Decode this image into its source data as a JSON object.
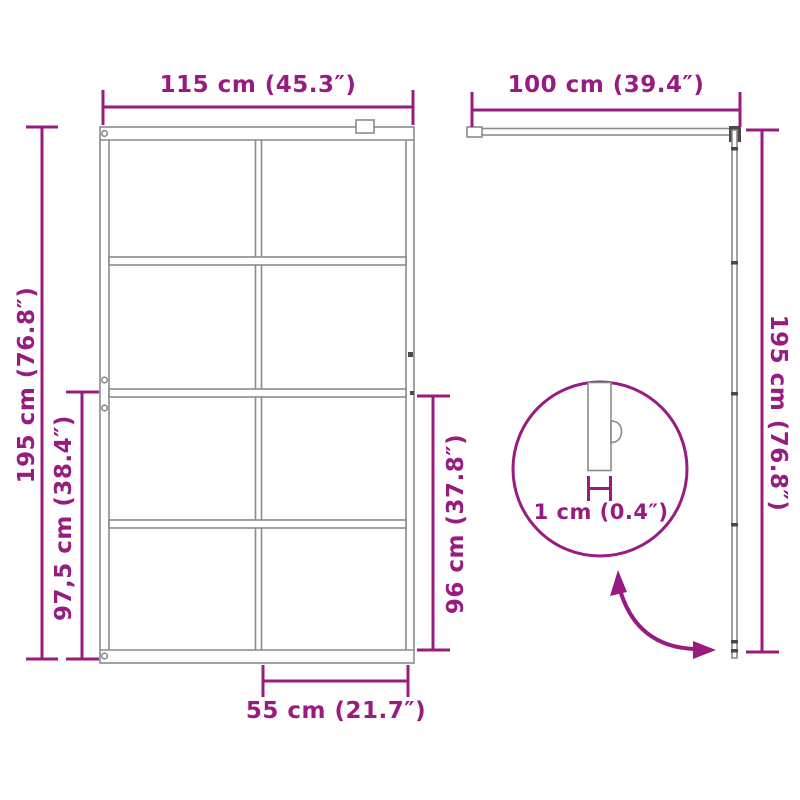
{
  "page": {
    "background": "#ffffff",
    "type": "product-dimension-diagram"
  },
  "colors": {
    "accent": "#981b80",
    "drawing_line": "#8a8a8a",
    "dark_fitting": "#4a4a4a"
  },
  "front_view": {
    "width_label": "115 cm (45.3″)",
    "height_label": "195 cm (76.8″)",
    "lower_height_label": "97,5 cm (38.4″)",
    "glass_height_label": "96 cm (37.8″)",
    "panel_width_label": "55 cm (21.7″)",
    "grid": {
      "rows": 4,
      "columns": 2
    }
  },
  "side_view": {
    "depth_label": "100 cm (39.4″)",
    "height_label": "195 cm (76.8″)"
  },
  "detail_view": {
    "thickness_label": "1 cm (0.4″)"
  }
}
